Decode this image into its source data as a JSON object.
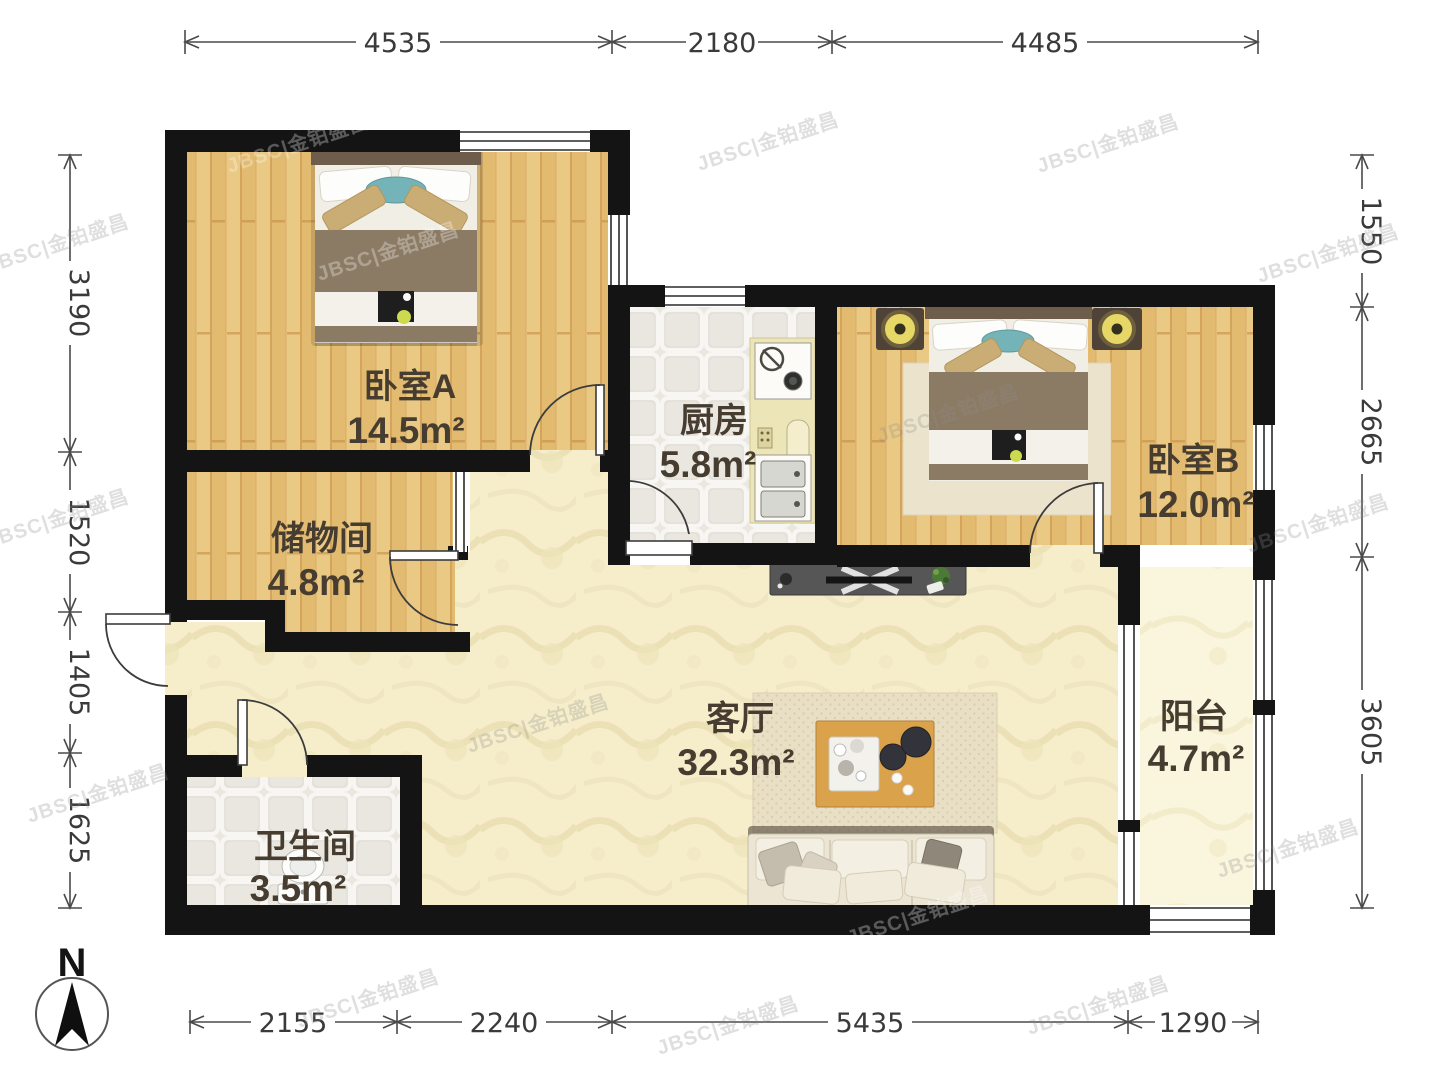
{
  "page": {
    "type": "apartment-floor-plan"
  },
  "rooms": [
    {
      "key": "bedroom-a",
      "name": "卧室A",
      "area": "14.5m²"
    },
    {
      "key": "kitchen",
      "name": "厨房",
      "area": "5.8m²"
    },
    {
      "key": "bedroom-b",
      "name": "卧室B",
      "area": "12.0m²"
    },
    {
      "key": "storage",
      "name": "储物间",
      "area": "4.8m²"
    },
    {
      "key": "living",
      "name": "客厅",
      "area": "32.3m²"
    },
    {
      "key": "bathroom",
      "name": "卫生间",
      "area": "3.5m²"
    },
    {
      "key": "balcony",
      "name": "阳台",
      "area": "4.7m²"
    }
  ],
  "dimensions_mm": {
    "top": [
      "4535",
      "2180",
      "4485"
    ],
    "bottom": [
      "2155",
      "2240",
      "5435",
      "1290"
    ],
    "left": [
      "3190",
      "1520",
      "1405",
      "1625"
    ],
    "right": [
      "1550",
      "2665",
      "3605"
    ]
  },
  "compass": {
    "north_label": "N"
  },
  "watermark": {
    "text": "JBSC|金铂盛昌"
  },
  "colors": {
    "wall": "#141414",
    "wood_floor": "#e8c27a",
    "tile_floor": "#e9e7e0",
    "living_floor": "#f6edca",
    "balcony_floor": "#faf5df",
    "dimension_text": "#3a3a3a",
    "label_text": "#463c30"
  }
}
